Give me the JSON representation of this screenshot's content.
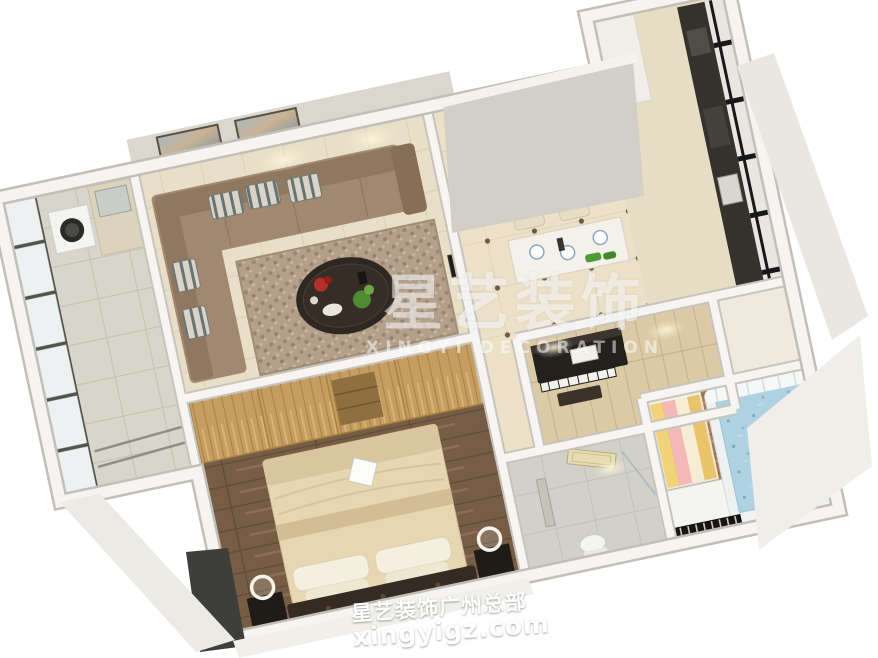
{
  "watermark_center": {
    "title": "星艺装饰",
    "subtitle": "XINGYI DECORATION"
  },
  "watermark_bottom": {
    "line1": "星艺装饰广州总部",
    "line2": "xingyigz.com"
  },
  "palette": {
    "background": "#ffffff",
    "wall_top": "#f5f4f0",
    "wall_face": "#d2cfc8",
    "living_tile": "#e9dfc8",
    "dining_tile": "#ece1c8",
    "sofa": "#a18971",
    "rug": "#b4a08a",
    "wardrobe_wood": "#c49d62",
    "bedroom_floor": "#775d46",
    "bedding": "#e7d6b2",
    "kids_floor": "#a87c50",
    "kids_mattress": "#aed2e2",
    "bathroom_tile": "#d6d4ca",
    "piano_black": "#24201c",
    "railing_black": "#17171c",
    "watermark_white": "rgba(255,255,255,0.52)"
  },
  "scene": {
    "description": "3D bird's-eye rendering of a furnished apartment floor plan",
    "rooms": [
      {
        "name": "balcony-laundry"
      },
      {
        "name": "living-room"
      },
      {
        "name": "dining-area"
      },
      {
        "name": "kitchen"
      },
      {
        "name": "piano-room"
      },
      {
        "name": "master-bedroom"
      },
      {
        "name": "bathroom"
      },
      {
        "name": "kids-room"
      }
    ]
  }
}
